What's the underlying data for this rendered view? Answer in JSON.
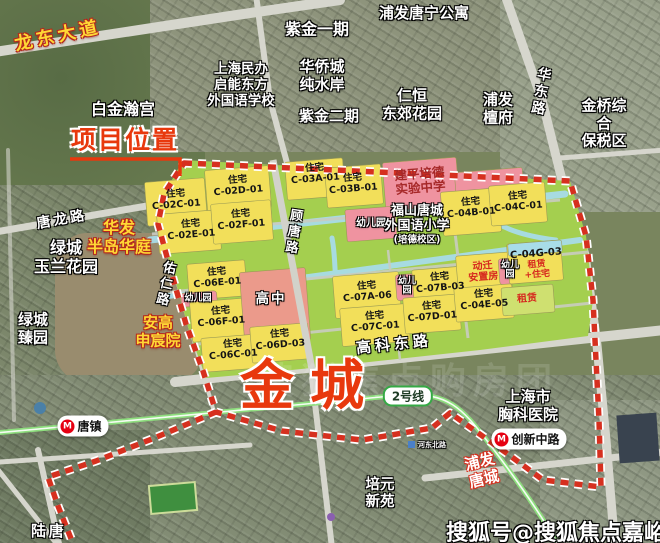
{
  "project": {
    "location_label": "项目位置",
    "name": "金城"
  },
  "roads": {
    "longdong": "龙东大道",
    "tanglong": "唐龙路",
    "youren": "佑仁路",
    "gutang": "顾唐路",
    "huadong": "华东路",
    "gaoke_east": "高科东路",
    "tang_partial": "唐陆",
    "hedong_north": "河东北路"
  },
  "places": {
    "baijin_hangong": "白金瀚宫",
    "zijin_phase1": "紫金一期",
    "pufa_tangning": "浦发唐宁公寓",
    "qineng_school": "上海民办\n启能东方\n外国语学校",
    "huaqiaocheng": "华侨城\n纯水岸",
    "zijin_phase2": "紫金二期",
    "renheng_dongjiao": "仁恒\n东郊花园",
    "pufa_tanfu": "浦发\n檀府",
    "jinqiao_bonded": "金桥综合\n保税区",
    "huafa_bandao": "华发\n半岛华庭",
    "lvcheng_yulan": "绿城\n玉兰花园",
    "lvcheng_zhenyuan": "绿城\n臻园",
    "angao_shenchen": "安高\n申宸院",
    "chest_hospital": "上海市\n胸科医院",
    "pufa_tangcheng": "浦发\n唐城",
    "peiyuan_xinyuan": "培元\n新苑"
  },
  "plan": {
    "jianping_school": "建平培德\n实验中学",
    "fushan_school": "福山唐城\n外国语小学",
    "fushan_campus": "(培德校区)",
    "high_school": "高中",
    "kindergarten": "幼儿园",
    "kindergarten_stacked": "幼儿\n园",
    "relocation": "动迁\n安置房",
    "rental": "租赁",
    "rental_mixed": "租赁\n+住宅",
    "c04g_code": "C-04G-03",
    "parcels": {
      "c02c": "住宅\nC-02C-01",
      "c02d": "住宅\nC-02D-01",
      "c02e": "住宅\nC-02E-01",
      "c02f": "住宅\nC-02F-01",
      "c03a": "住宅\nC-03A-01",
      "c03b": "住宅\nC-03B-01",
      "c04b": "住宅\nC-04B-01",
      "c04c": "住宅\nC-04C-01",
      "c04e": "住宅\nC-04E-05",
      "c06c": "住宅\nC-06C-01",
      "c06d": "住宅\nC-06D-03",
      "c06e": "住宅\nC-06E-01",
      "c06f": "住宅\nC-06F-01",
      "c07a": "住宅\nC-07A-06",
      "c07b": "住宅\nC-07B-03",
      "c07c": "住宅\nC-07C-01",
      "c07d": "住宅\nC-07D-01"
    }
  },
  "transit": {
    "tangzhen_station": "唐镇",
    "chuangxin_station": "创新中路",
    "line2_badge": "2号线",
    "metro_logo": "M"
  },
  "watermark": {
    "main": "搜狐号@搜狐焦点嘉峪关站",
    "ghost": "搜狐焦点购房团"
  },
  "colors": {
    "boundary_red": "#d6301f",
    "parcel_yellow": "#f2df5a",
    "school_pink": "#ef93a0",
    "plan_green": "#a4cf4f",
    "water_cyan": "#a8dce8",
    "metro_green": "#8ede7e",
    "accent_red": "#e8380d"
  }
}
